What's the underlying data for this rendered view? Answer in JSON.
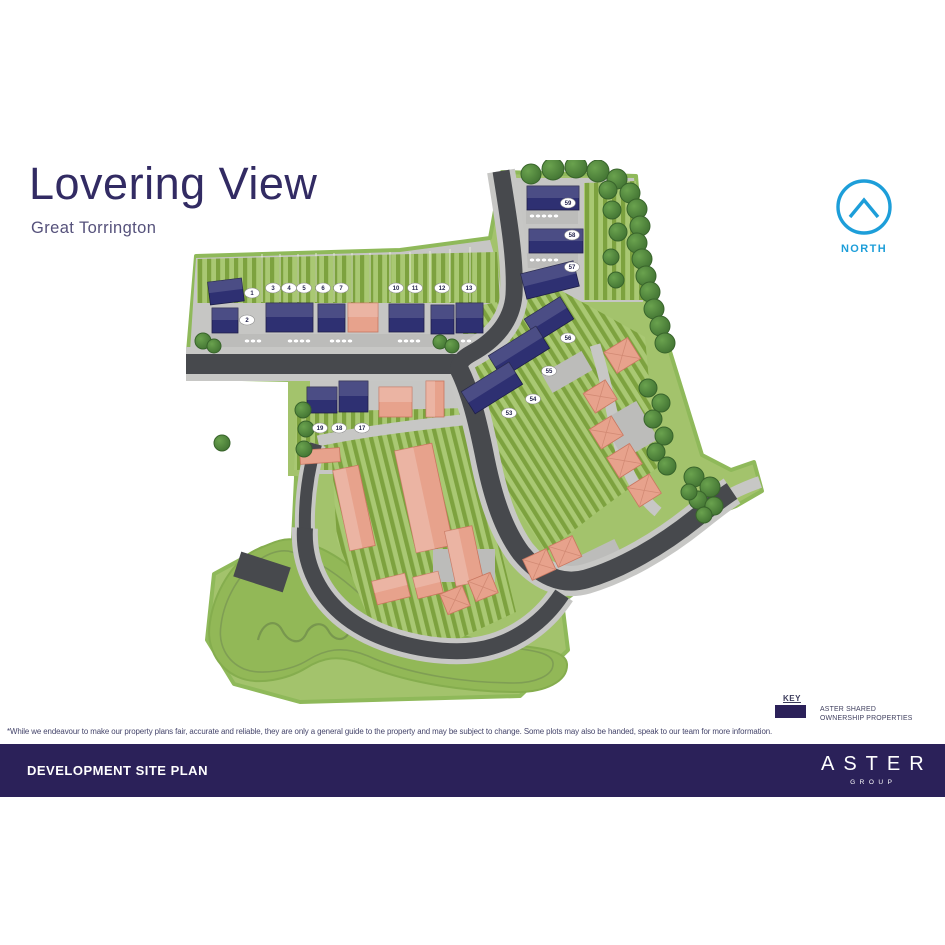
{
  "header": {
    "title": "Lovering View",
    "subtitle": "Great Torrington"
  },
  "north_indicator": {
    "label": "NORTH",
    "color": "#1d9ed9"
  },
  "key": {
    "heading": "KEY",
    "items": [
      {
        "swatch_color": "#2b2159",
        "label_line1": "ASTER SHARED",
        "label_line2": "OWNERSHIP PROPERTIES"
      }
    ]
  },
  "disclaimer": "*While we endeavour to make our property plans fair, accurate and reliable, they are only a general guide to the property and may be subject to change. Some plots may also be handed, speak to our team for more information.",
  "footer": {
    "title": "DEVELOPMENT SITE PLAN",
    "brand": "ASTER",
    "brand_sub": "GROUP"
  },
  "map": {
    "plots": [
      {
        "label": "1",
        "x": 252,
        "y": 293
      },
      {
        "label": "2",
        "x": 247,
        "y": 320
      },
      {
        "label": "3",
        "x": 273,
        "y": 288
      },
      {
        "label": "4",
        "x": 289,
        "y": 288
      },
      {
        "label": "5",
        "x": 304,
        "y": 288
      },
      {
        "label": "6",
        "x": 323,
        "y": 288
      },
      {
        "label": "7",
        "x": 341,
        "y": 288
      },
      {
        "label": "10",
        "x": 396,
        "y": 288
      },
      {
        "label": "11",
        "x": 415,
        "y": 288
      },
      {
        "label": "12",
        "x": 442,
        "y": 288
      },
      {
        "label": "13",
        "x": 469,
        "y": 288
      },
      {
        "label": "17",
        "x": 362,
        "y": 428
      },
      {
        "label": "18",
        "x": 339,
        "y": 428
      },
      {
        "label": "19",
        "x": 320,
        "y": 428
      },
      {
        "label": "53",
        "x": 509,
        "y": 413
      },
      {
        "label": "54",
        "x": 533,
        "y": 399
      },
      {
        "label": "55",
        "x": 549,
        "y": 371
      },
      {
        "label": "56",
        "x": 568,
        "y": 338
      },
      {
        "label": "57",
        "x": 572,
        "y": 267
      },
      {
        "label": "58",
        "x": 572,
        "y": 235
      },
      {
        "label": "59",
        "x": 568,
        "y": 203
      }
    ],
    "colors": {
      "shared_ownership_house": "#2e3072",
      "open_market_house": "#e7a28c",
      "road": "#47494d",
      "pavement": "#c7c7c5",
      "garden_light": "#a9c873",
      "garden_dark": "#7da23f",
      "open_space": "#92b857",
      "tree": "#467c36"
    }
  }
}
